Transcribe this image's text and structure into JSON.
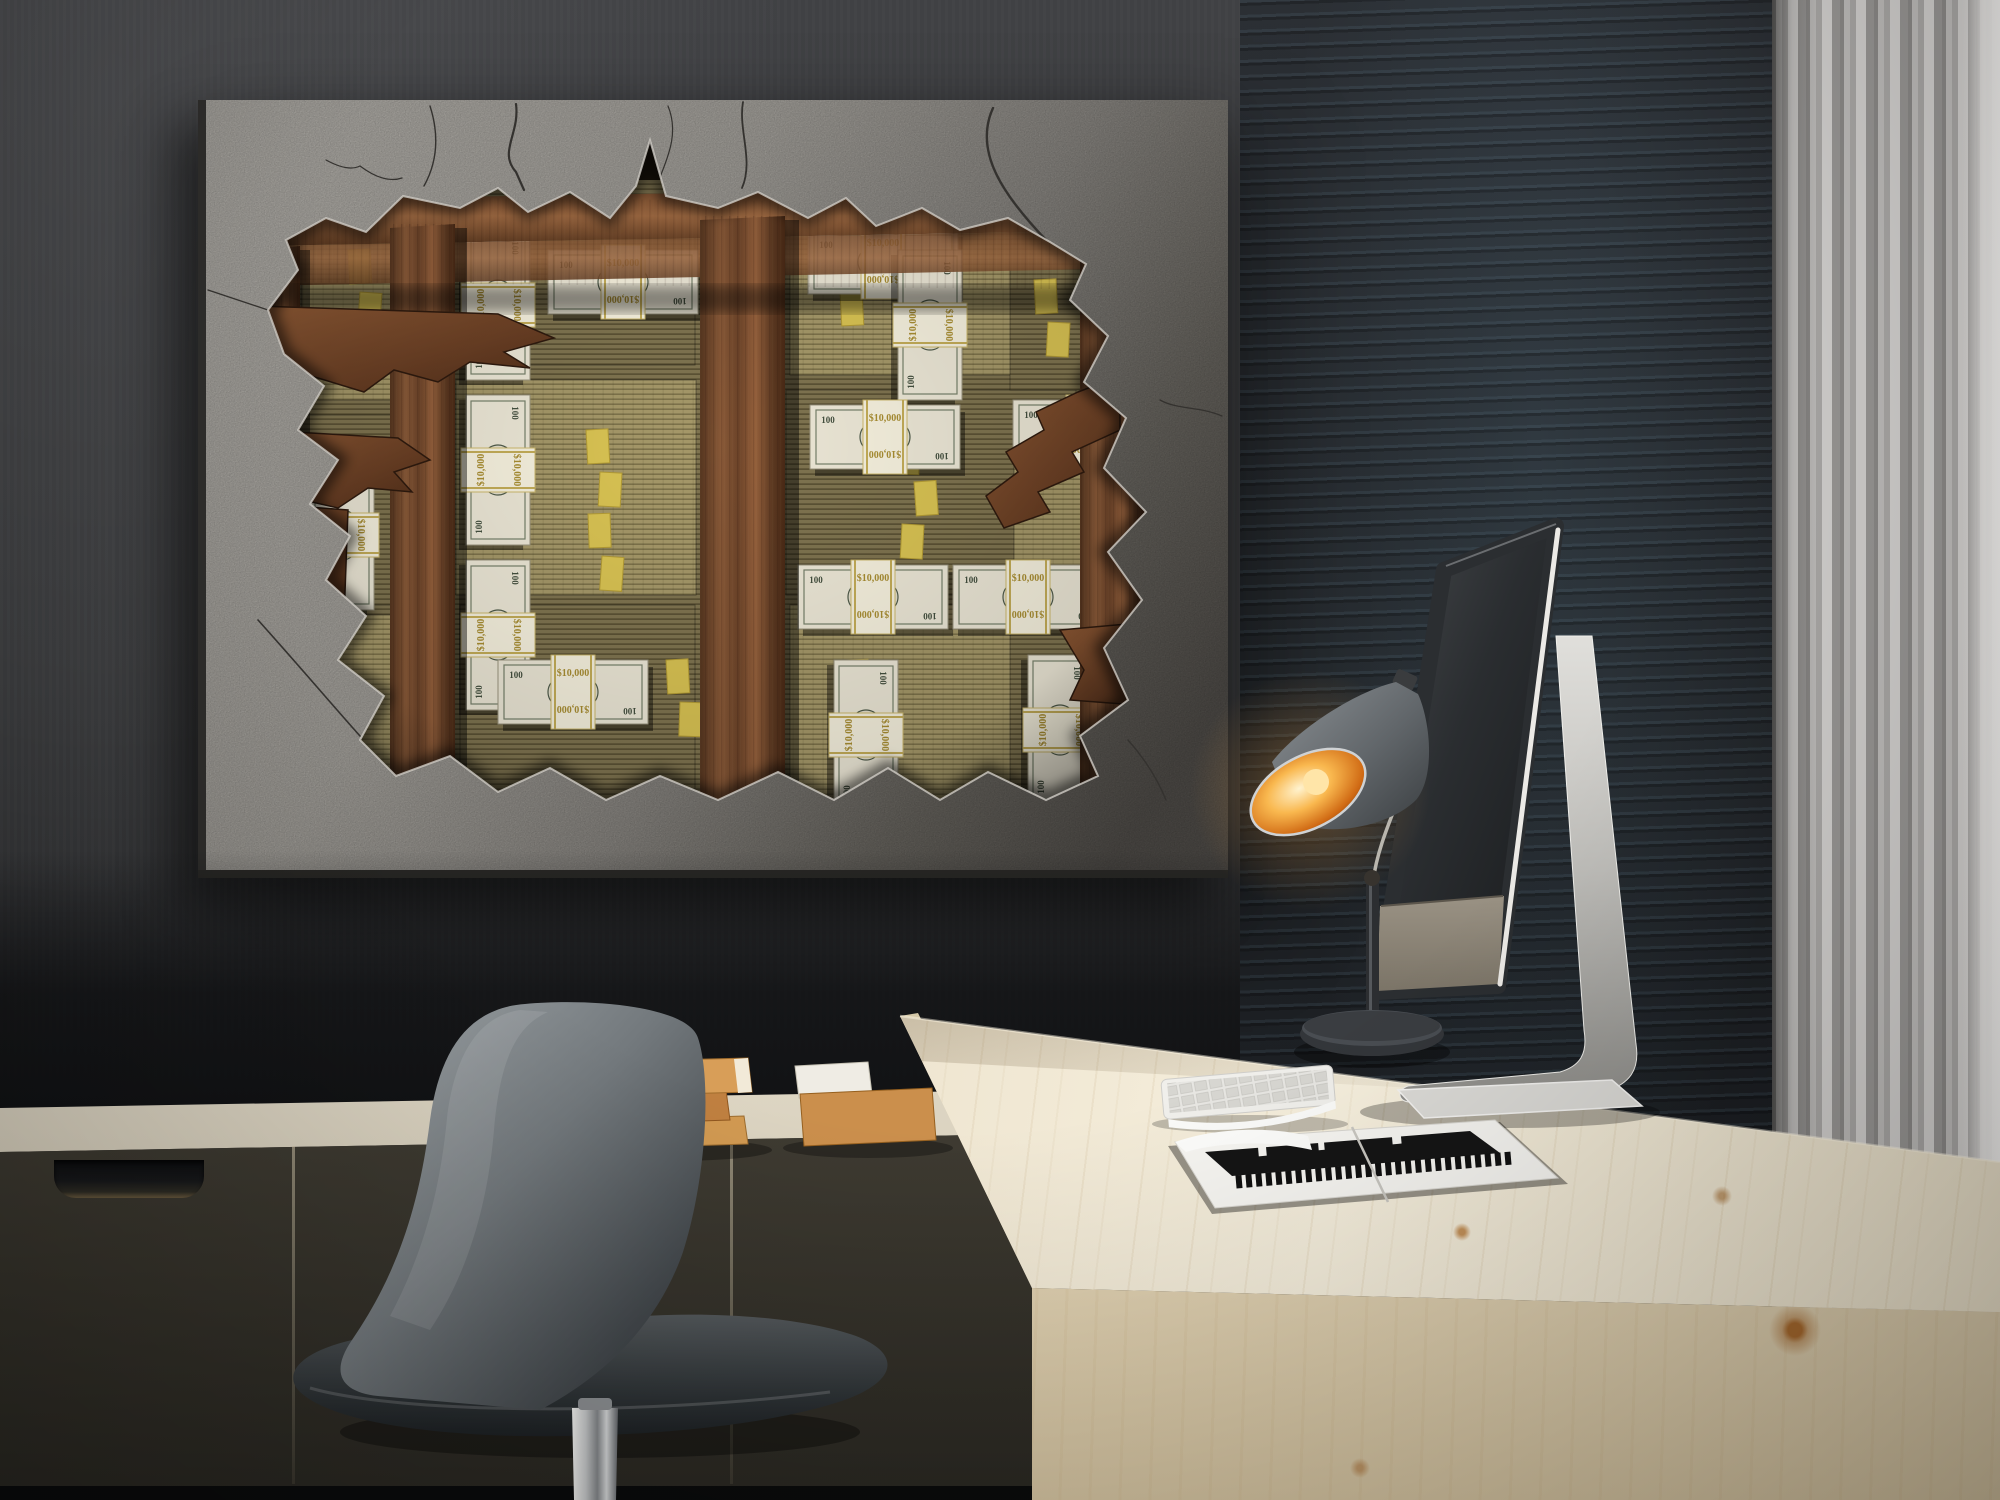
{
  "scene": {
    "type": "office-interior-photo"
  },
  "artwork": {
    "band_label": "$10,000",
    "bill_denomination": "100"
  },
  "palette": {
    "wall_left": "#3a3b3d",
    "wall_right": "#22262a",
    "wall_sheen": "#5b7b8c",
    "curtain": "#bcbab8",
    "curtain_highlight": "#f0efed",
    "concrete_light": "#b2afa9",
    "concrete_shadow": "#55524e",
    "hole_void": "#17110a",
    "plank_wood": "#7b4e31",
    "cash_stack": "#978b5e",
    "cash_strap": "#d9c353",
    "bill_face": "#ece7d6",
    "band_text": "#a98e32",
    "desk_wood": "#f1e9d6",
    "sideboard_front": "#5c584b",
    "sideboard_top": "#ece6d9",
    "chair_shell": "#6a7074",
    "chrome": "#c6c9cb",
    "lamp_shade": "#70757a",
    "lamp_glow": "#f29a2e",
    "imac_back": "#2b2e31",
    "imac_chin": "#8f887b",
    "aluminum": "#cfcecb",
    "keyboard": "#e6e6e2",
    "magazine_page": "#f7f6f2",
    "magazine_ink": "#161616",
    "book_tan": "#d0964f"
  },
  "objects": {
    "wall_art": "torn-concrete-money-canvas",
    "desk": "light-wood-desk",
    "computer": "imac-rear-view",
    "lamp": "desk-lamp",
    "keyboard": "white-keyboard",
    "magazine": "open-magazine",
    "chair": "gray-swivel-chair",
    "sideboard": "drawer-sideboard",
    "books": "wooden-book-stacks",
    "curtain": "sheer-curtain"
  }
}
